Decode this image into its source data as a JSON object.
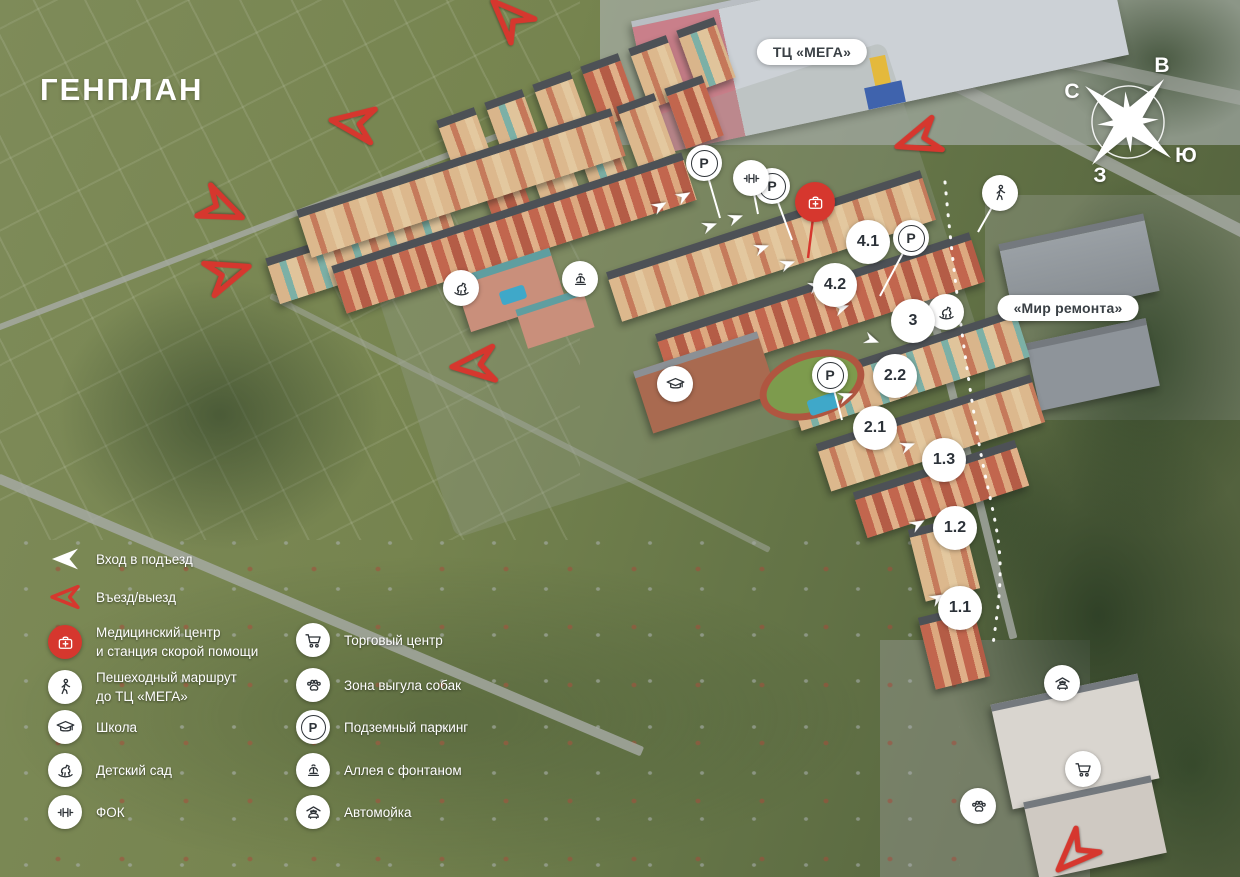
{
  "title": "ГЕНПЛАН",
  "map_labels": {
    "mega_mall": "ТЦ «МЕГА»",
    "mir_remonta": "«Мир ремонта»"
  },
  "compass": {
    "north": "С",
    "east": "В",
    "south": "Ю",
    "west": "З"
  },
  "parking_symbol": "P",
  "building_badges": [
    "4.1",
    "4.2",
    "3",
    "2.2",
    "2.1",
    "1.3",
    "1.2",
    "1.1"
  ],
  "legend": {
    "column1": [
      {
        "icon": "entrance-triangle",
        "lines": [
          "Вход в подъезд"
        ]
      },
      {
        "icon": "entry-exit-arrow",
        "lines": [
          "Въезд/выезд"
        ]
      },
      {
        "icon": "medical-center-icon",
        "lines": [
          "Медицинский центр",
          "и станция скорой помощи"
        ]
      },
      {
        "icon": "pedestrian-route-icon",
        "lines": [
          "Пешеходный маршрут",
          "до ТЦ «МЕГА»"
        ]
      },
      {
        "icon": "school-icon",
        "lines": [
          "Школа"
        ]
      },
      {
        "icon": "kindergarten-icon",
        "lines": [
          "Детский сад"
        ]
      },
      {
        "icon": "gym-icon",
        "lines": [
          "ФОК"
        ]
      }
    ],
    "column2": [
      {
        "icon": "shopping-cart-icon",
        "lines": [
          "Торговый центр"
        ]
      },
      {
        "icon": "dog-walking-icon",
        "lines": [
          "Зона выгула собак"
        ]
      },
      {
        "icon": "parking-icon",
        "lines": [
          "Подземный паркинг"
        ]
      },
      {
        "icon": "fountain-icon",
        "lines": [
          "Аллея с фонтаном"
        ]
      },
      {
        "icon": "car-wash-icon",
        "lines": [
          "Автомойка"
        ]
      }
    ]
  },
  "colors": {
    "accent_red": "#d6372e",
    "badge_text": "#2b3138"
  }
}
